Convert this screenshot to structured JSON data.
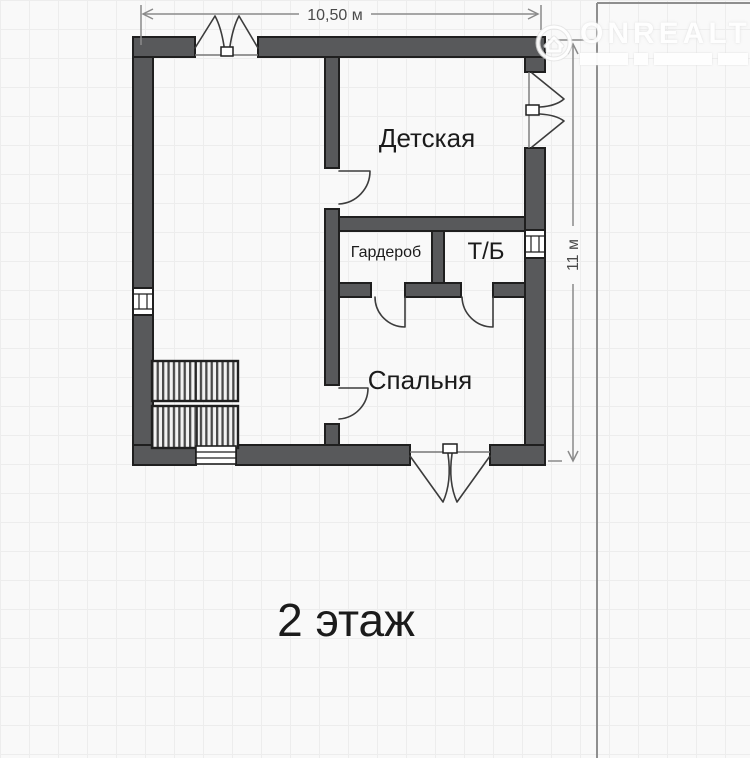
{
  "floor": {
    "label": "2 этаж"
  },
  "dimensions": {
    "width_label": "10,50 м",
    "height_label": "11 м"
  },
  "rooms": [
    {
      "name": "Детская"
    },
    {
      "name": "Гардероб"
    },
    {
      "name": "Т/Б"
    },
    {
      "name": "Спальня"
    }
  ],
  "watermark": {
    "brand": "ONREALT"
  },
  "colors": {
    "wall": "#58595b",
    "outline": "#1f1f1f",
    "dim": "#8b8b8b",
    "sym": "#3c3c3c",
    "text": "#1b1b1b",
    "grid": "#ededed",
    "bg": "#f9f9f9"
  }
}
